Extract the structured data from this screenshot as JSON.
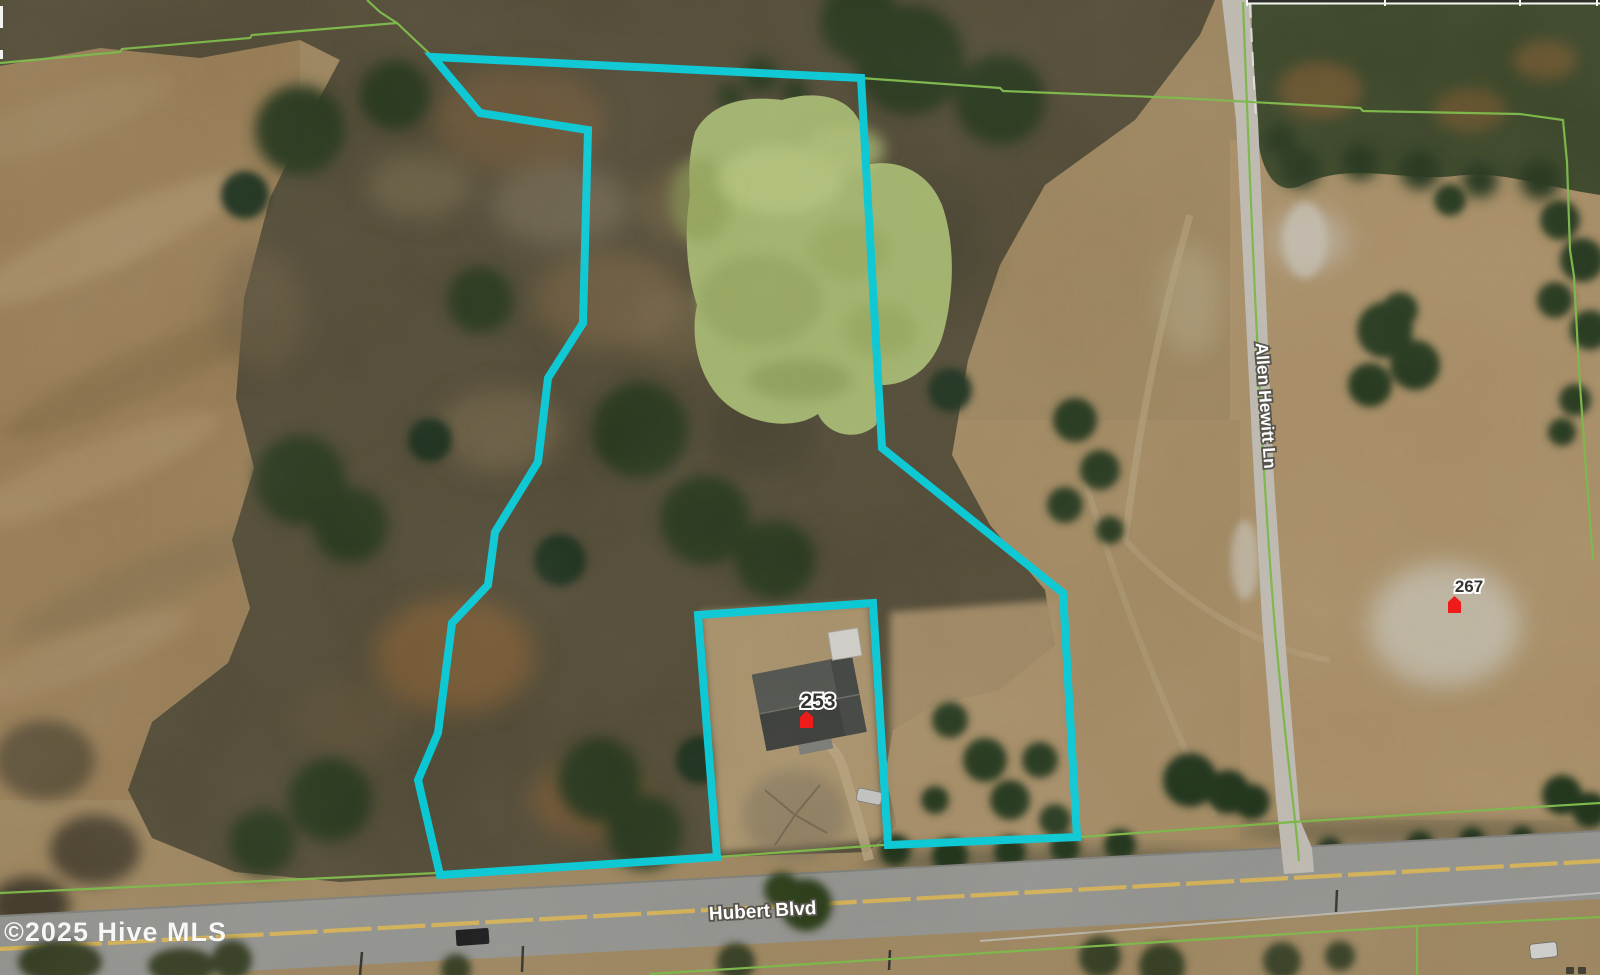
{
  "map": {
    "watermark": "©2025 Hive MLS",
    "road_labels": {
      "vertical_road": "Allen Hewitt Ln",
      "horizontal_road": "Hubert Blvd"
    },
    "parcel_labels": {
      "parcel_253": "253",
      "parcel_267": "267"
    },
    "colors": {
      "boundary_cyan": "#0ae4f2",
      "parcel_line_green": "#8ccf52",
      "marker_red": "#ee1b1b",
      "road_centerline_yellow": "#eec863"
    }
  }
}
